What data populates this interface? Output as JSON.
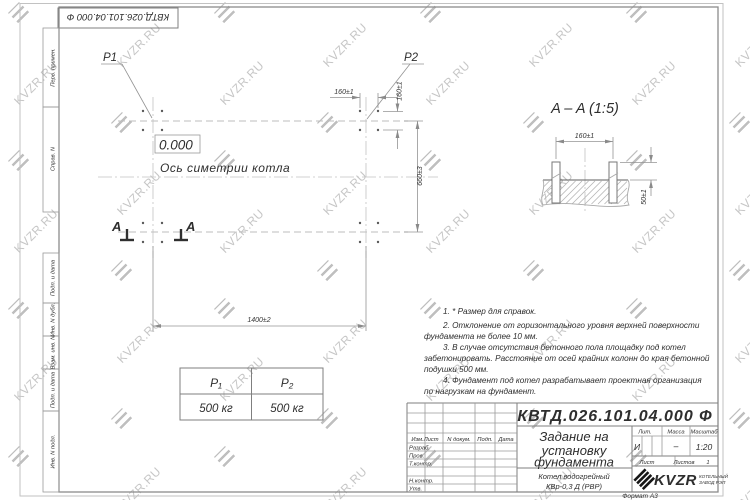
{
  "watermark": {
    "text": "KVZR.RU"
  },
  "corner_stamp": {
    "code": "КВТД.026.101.04.000 Ф"
  },
  "margin_fields": {
    "top": [
      "Перв. примен.",
      "Справ. N"
    ],
    "bottom": [
      "Подп. и дата",
      "Инв. N дубл.",
      "Взам. инв. N",
      "Подп. и дата",
      "Инв. N подл."
    ]
  },
  "plan": {
    "p1": "P1",
    "p2": "P2",
    "elevation": "0.000",
    "axis_label": "Ось симетрии котла",
    "section_letter_left": "A",
    "section_letter_right": "A",
    "dim_bolt_spacing_h": "160±1",
    "dim_bolt_spacing_v": "160±1",
    "dim_length": "1400±2",
    "dim_width": "660±3"
  },
  "section_view": {
    "title": "A – A (1:5)",
    "dim_spacing": "160±1",
    "dim_height": "50±1"
  },
  "notes": {
    "lines": [
      "1. * Размер для справок.",
      "2. Отклонение от горизонтального уровня верхней поверхности",
      "фундамента не более 10 мм.",
      "3. В случае отсутствия бетонного пола площадку под котел",
      "забетонировать. Расстояние от осей крайних колонн до края бетонной",
      "подушки 500 мм.",
      "4. Фундамент под котел разрабатывает проектная организация",
      "по нагрузкам на фундамент."
    ]
  },
  "load_table": {
    "headers": [
      "P₁",
      "P₂"
    ],
    "values": [
      "500 кг",
      "500 кг"
    ]
  },
  "title_block": {
    "doc_number": "КВТД.026.101.04.000  Ф",
    "title_lines": [
      "Задание на",
      "установку",
      "фундамента"
    ],
    "product_lines": [
      "Котел водогрейный",
      "КВр-0,3 Д (РВР)"
    ],
    "rev_header": "Изм.Лист",
    "doc_col": "N докум.",
    "sign_col": "Подп.",
    "date_col": "Дата",
    "roles": [
      "Разраб.",
      "Пров.",
      "Т.контр.",
      "Н.контр.",
      "Утв."
    ],
    "lit_label": "Лит.",
    "lit_value": "И",
    "mass_label": "Масса",
    "mass_value": "–",
    "scale_label": "Масштаб",
    "scale_value": "1:20",
    "sheet_label": "Лист",
    "sheets_label": "Листов",
    "sheets_value": "1",
    "company": {
      "logo": "KVZR",
      "tagline1": "КОТЕЛЬНЫЙ",
      "tagline2": "ЗАВОД РЭП"
    },
    "format_label": "Формат А3"
  }
}
